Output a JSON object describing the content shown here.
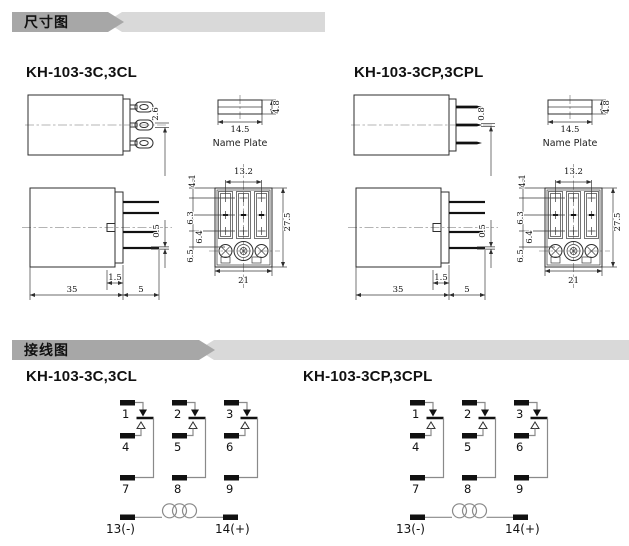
{
  "banners": {
    "dimensions": "尺寸图",
    "wiring": "接线图"
  },
  "models": {
    "left": "KH-103-3C,3CL",
    "right": "KH-103-3CP,3CPL"
  },
  "dims": {
    "pin_3c": "2.6",
    "pin_3cp": "0.8",
    "plate_w": "14.5",
    "plate_t": "4.8",
    "plate_label": "Name Plate",
    "body_w": "35",
    "step": "1.5",
    "pin_len": "5",
    "pin_t": "0.5",
    "pitch": "13.2",
    "r1": "4.1",
    "r2": "6.3",
    "r3": "6.4",
    "r4": "6.5",
    "socket_h": "27.5",
    "socket_w": "21"
  },
  "wiring": {
    "t": [
      "1",
      "2",
      "3",
      "4",
      "5",
      "6",
      "7",
      "8",
      "9"
    ],
    "neg": "13(-)",
    "pos": "14(+)"
  },
  "colors": {
    "banner_dark": "#a7a7a7",
    "banner_light": "#d9d9d9",
    "line": "#2e2e2e",
    "wire": "#8a8a8a"
  }
}
